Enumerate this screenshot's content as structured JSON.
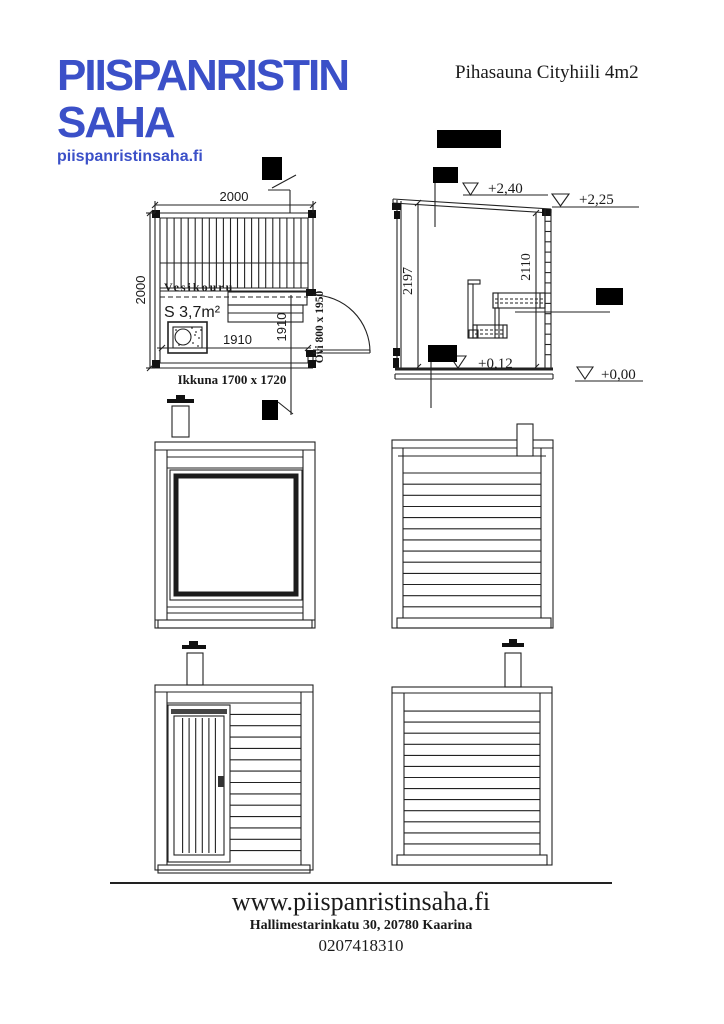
{
  "header": {
    "logo": {
      "line1": "PIISPANRISTIN",
      "line2": "SAHA",
      "url": "piispanristinsaha.fi",
      "color": "#3b50c8"
    },
    "title": "Pihasauna Cityhiili 4m2"
  },
  "plan": {
    "dim_top": "2000",
    "dim_left": "2000",
    "dim_inner_width": "1910",
    "dim_inner_depth": "1910",
    "area_label": "S 3,7m²",
    "deck_label": "Vesikouru",
    "window_label": "Ikkuna 1700 x 1720",
    "door_label": "Ovi 800 x 1950"
  },
  "section": {
    "dim_height_left": "2197",
    "dim_height_right": "2110",
    "level_ridge": "+2,40",
    "level_eave": "+2,25",
    "level_floor": "+0,12",
    "level_ground": "+0,00"
  },
  "footer": {
    "website": "www.piispanristinsaha.fi",
    "address": "Hallimestarinkatu 30, 20780 Kaarina",
    "phone": "0207418310"
  }
}
